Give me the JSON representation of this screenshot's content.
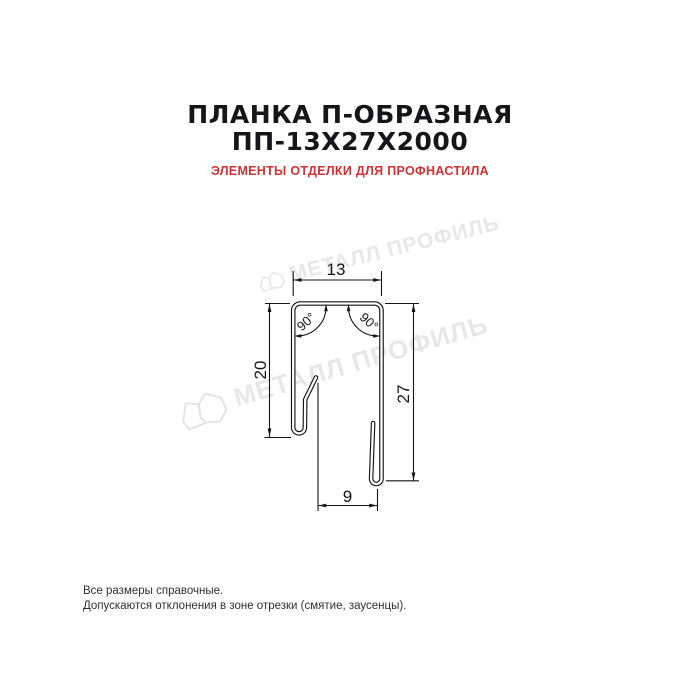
{
  "page": {
    "background": "#ffffff"
  },
  "header": {
    "title_line1": "ПЛАНКА П-ОБРАЗНАЯ",
    "title_line2": "ПП-13Х27Х2000",
    "subtitle": "ЭЛЕМЕНТЫ ОТДЕЛКИ ДЛЯ ПРОФНАСТИЛА",
    "title_color": "#15151a",
    "subtitle_color": "#cc3333"
  },
  "drawing": {
    "type": "profile-cross-section",
    "description": "U-shaped metal strip cross-section with hemmed edges",
    "line_color": "#151515",
    "dims": {
      "top_width": "13",
      "left_height": "20",
      "right_height": "27",
      "bottom_width": "9",
      "angle_left": "90°",
      "angle_right": "90°"
    }
  },
  "watermark": {
    "text": "МЕТАЛЛ ПРОФИЛЬ",
    "color": "#e7e7e9"
  },
  "footer": {
    "line1": "Все размеры справочные.",
    "line2": "Допускаются отклонения в зоне отрезки (смятие, заусенцы).",
    "color": "#2f2f2f"
  }
}
